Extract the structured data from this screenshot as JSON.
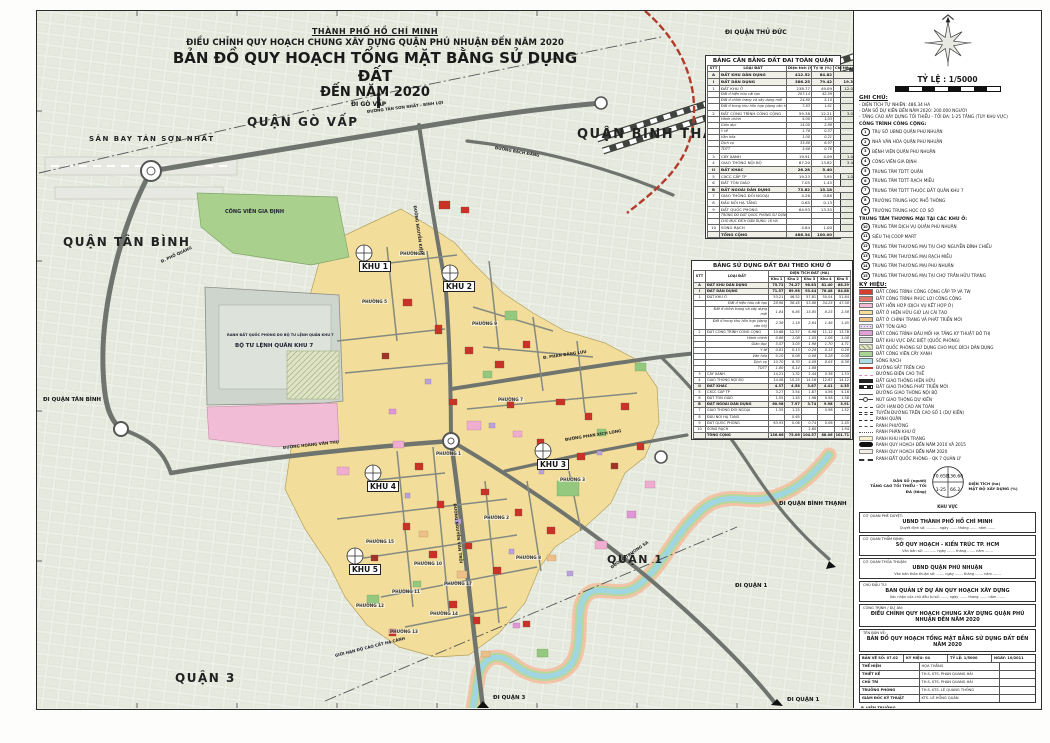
{
  "title": {
    "city": "THÀNH PHỐ HỒ CHÍ MINH",
    "line1": "ĐIỀU CHỈNH QUY HOẠCH CHUNG XÂY DỰNG QUẬN PHÚ NHUẬN ĐẾN NĂM 2020",
    "line2": "BẢN ĐỒ QUY HOẠCH TỔNG MẶT BẰNG SỬ DỤNG ĐẤT",
    "line3": "ĐẾN NĂM 2020"
  },
  "map": {
    "regions": [
      "QUẬN GÒ VẤP",
      "QUẬN BÌNH THẠNH",
      "QUẬN TÂN BÌNH",
      "QUẬN 1",
      "QUẬN 3",
      "SÂN BAY TÂN SƠN NHẤT"
    ],
    "directions": [
      "ĐI QUẬN THỦ ĐỨC",
      "ĐI GÒ VẤP",
      "ĐI QUẬN TÂN BÌNH",
      "ĐI QUẬN BÌNH THẠNH",
      "ĐI QUẬN 1",
      "ĐI QUẬN 1",
      "ĐI QUẬN 3"
    ],
    "khu": [
      "KHU 1",
      "KHU 2",
      "KHU 3",
      "KHU 4",
      "KHU 5"
    ],
    "wards": [
      "PHƯỜNG 4",
      "PHƯỜNG 5",
      "PHƯỜNG 9",
      "PHƯỜNG 7",
      "PHƯỜNG 1",
      "PHƯỜNG 3",
      "PHƯỜNG 2",
      "PHƯỜNG 8",
      "PHƯỜNG 15",
      "PHƯỜNG 10",
      "PHƯỜNG 17",
      "PHƯỜNG 11",
      "PHƯỜNG 12",
      "PHƯỜNG 13",
      "PHƯỜNG 14"
    ],
    "roads": [
      "ĐƯỜNG TÂN SƠN NHẤT - BÌNH LỢI",
      "ĐƯỜNG BẠCH ĐẰNG",
      "ĐƯỜNG NGUYỄN KIỆM",
      "Đ. PHỔ QUANG",
      "ĐƯỜNG HOÀNG VĂN THỤ",
      "Đ. PHAN ĐĂNG LƯU",
      "ĐƯỜNG NGUYỄN VĂN TRỖI",
      "ĐƯỜNG PHAN XÍCH LONG",
      "ĐƯỜNG TRƯỜNG SA"
    ],
    "pois": [
      "CÔNG VIÊN GIA ĐỊNH",
      "RANH ĐẤT QUỐC PHÒNG DO BỘ TƯ LỆNH QUÂN KHU 7",
      "BỘ TƯ LỆNH QUÂN KHU 7",
      "GIỚI HẠN ĐỘ CAO CẤT HẠ CÁNH"
    ]
  },
  "table_quan": {
    "title": "BẢNG CÂN BẰNG ĐẤT ĐAI TOÀN QUẬN",
    "headers": [
      "STT",
      "LOẠI ĐẤT",
      "Diện tích (ha)",
      "Tỷ lệ (%)",
      "Chỉ tiêu (m²/ng)"
    ],
    "rows": [
      {
        "stt": "A",
        "name": "ĐẤT KHU DÂN DỤNG",
        "a": "412.52",
        "b": "84.82",
        "c": "",
        "k": "head"
      },
      {
        "stt": "I",
        "name": "ĐẤT DÂN DỤNG",
        "a": "386.25",
        "b": "79.42",
        "c": "19.3",
        "k": "head"
      },
      {
        "stt": "1",
        "name": "ĐẤT KHU Ở",
        "a": "238.77",
        "b": "49.09",
        "c": "12.0",
        "k": "num"
      },
      {
        "stt": "",
        "name": "Đất ở hiện hữu cải tạo",
        "a": "207.14",
        "b": "42.59",
        "c": "",
        "k": "sub"
      },
      {
        "stt": "",
        "name": "Đất ở chỉnh trang và xây dựng mới",
        "a": "24.80",
        "b": "5.10",
        "c": "",
        "k": "sub"
      },
      {
        "stt": "",
        "name": "Đất ở trong khu hỗn hợp (dạng căn hộ)",
        "a": "7.83",
        "b": "1.61",
        "c": "",
        "k": "sub"
      },
      {
        "stt": "2",
        "name": "ĐẤT CÔNG TRÌNH CÔNG CỘNG",
        "a": "59.38",
        "b": "12.21",
        "c": "3.0",
        "k": "num"
      },
      {
        "stt": "",
        "name": "Hành chính",
        "a": "5.00",
        "b": "1.03",
        "c": "",
        "k": "sub"
      },
      {
        "stt": "",
        "name": "Giáo dục",
        "a": "14.00",
        "b": "2.88",
        "c": "",
        "k": "sub"
      },
      {
        "stt": "",
        "name": "Y tế",
        "a": "1.78",
        "b": "0.37",
        "c": "",
        "k": "sub"
      },
      {
        "stt": "",
        "name": "Văn hóa",
        "a": "1.00",
        "b": "0.21",
        "c": "",
        "k": "sub"
      },
      {
        "stt": "",
        "name": "Dịch vụ",
        "a": "33.88",
        "b": "6.97",
        "c": "",
        "k": "sub"
      },
      {
        "stt": "",
        "name": "TDTT",
        "a": "3.68",
        "b": "0.76",
        "c": "",
        "k": "sub"
      },
      {
        "stt": "3",
        "name": "CÂY XANH",
        "a": "19.91",
        "b": "4.09",
        "c": "1.0",
        "k": "num"
      },
      {
        "stt": "4",
        "name": "GIAO THÔNG NỘI BỘ",
        "a": "67.20",
        "b": "13.82",
        "c": "3.4",
        "k": "num"
      },
      {
        "stt": "II",
        "name": "ĐẤT KHÁC",
        "a": "26.28",
        "b": "5.40",
        "c": "",
        "k": "head"
      },
      {
        "stt": "5",
        "name": "CXCC CẤP TP",
        "a": "19.23",
        "b": "3.95",
        "c": "1.0",
        "k": "num"
      },
      {
        "stt": "6",
        "name": "ĐẤT TÔN GIÁO",
        "a": "7.05",
        "b": "1.45",
        "c": "",
        "k": "num"
      },
      {
        "stt": "B",
        "name": "ĐẤT NGOÀI DÂN DỤNG",
        "a": "73.82",
        "b": "15.18",
        "c": "",
        "k": "head"
      },
      {
        "stt": "7",
        "name": "GIAO THÔNG ĐỐI NGOẠI",
        "a": "4.26",
        "b": "0.88",
        "c": "",
        "k": "num"
      },
      {
        "stt": "8",
        "name": "ĐẤU NỐI HẠ TẦNG",
        "a": "0.65",
        "b": "0.13",
        "c": "",
        "k": "num"
      },
      {
        "stt": "9",
        "name": "ĐẤT QUỐC PHÒNG",
        "a": "64.93",
        "b": "13.35",
        "c": "",
        "k": "num"
      },
      {
        "stt": "",
        "name": "TRONG ĐÓ ĐẤT QUỐC PHÒNG SỬ DỤNG",
        "a": "",
        "b": "",
        "c": "",
        "k": "note"
      },
      {
        "stt": "",
        "name": "CHO MỤC ĐÍCH DÂN DỤNG: 16 HA",
        "a": "",
        "b": "",
        "c": "",
        "k": "note"
      },
      {
        "stt": "10",
        "name": "SÔNG RẠCH",
        "a": "4.84",
        "b": "1.00",
        "c": "",
        "k": "num"
      },
      {
        "stt": "",
        "name": "TỔNG CỘNG",
        "a": "486.34",
        "b": "100.00",
        "c": "",
        "k": "total"
      }
    ]
  },
  "table_khu": {
    "title": "BẢNG SỬ DỤNG ĐẤT ĐAI THEO KHU Ở",
    "group_header": "DIỆN TÍCH ĐẤT (HA)",
    "headers": [
      "STT",
      "LOẠI ĐẤT"
    ],
    "khu_headers": [
      "Khu 1",
      "Khu 2",
      "Khu 3",
      "Khu 4",
      "Khu 5"
    ],
    "rows": [
      {
        "stt": "A",
        "name": "ĐẤT KHU DÂN DỤNG",
        "v": [
          "75.72",
          "74.27",
          "98.83",
          "81.40",
          "88.29"
        ],
        "k": "head"
      },
      {
        "stt": "I",
        "name": "ĐẤT DÂN DỤNG",
        "v": [
          "71.57",
          "69.98",
          "93.44",
          "76.48",
          "84.88"
        ],
        "k": "head"
      },
      {
        "stt": "1",
        "name": "ĐẤT KHU Ở",
        "v": [
          "53.21",
          "46.52",
          "57.81",
          "50.04",
          "51.84"
        ],
        "k": "num"
      },
      {
        "stt": "",
        "name": "Đất ở hiện hữu cải tạo",
        "v": [
          "28.96",
          "36.45",
          "53.88",
          "34.25",
          "47.58"
        ],
        "k": "sub"
      },
      {
        "stt": "",
        "name": "Đất ở chỉnh trang và xây dựng mới",
        "v": [
          "1.84",
          "6.85",
          "15.85",
          "8.25",
          "2.58"
        ],
        "k": "sub"
      },
      {
        "stt": "",
        "name": "Đất ở trong khu hỗn hợp (dạng căn hộ)",
        "v": [
          "2.38",
          "1.18",
          "2.84",
          "1.46",
          "1.45"
        ],
        "k": "sub"
      },
      {
        "stt": "2",
        "name": "ĐẤT CÔNG TRÌNH CÔNG CỘNG",
        "v": [
          "10.68",
          "12.57",
          "8.98",
          "11.12",
          "13.78"
        ],
        "k": "num"
      },
      {
        "stt": "",
        "name": "Hành chính",
        "v": [
          "0.88",
          "1.08",
          "1.05",
          "1.06",
          "1.08"
        ],
        "k": "sub"
      },
      {
        "stt": "",
        "name": "Giáo dục",
        "v": [
          "5.57",
          "3.03",
          "1.98",
          "1.70",
          "4.71"
        ],
        "k": "sub"
      },
      {
        "stt": "",
        "name": "Y tế",
        "v": [
          "0.81",
          "0.13",
          "0.28",
          "0.15",
          "0.28"
        ],
        "k": "sub"
      },
      {
        "stt": "",
        "name": "Văn hóa",
        "v": [
          "0.10",
          "0.08",
          "0.08",
          "0.28",
          "0.08"
        ],
        "k": "sub"
      },
      {
        "stt": "",
        "name": "Dịch vụ",
        "v": [
          "10.70",
          "6.70",
          "4.09",
          "8.05",
          "6.38"
        ],
        "k": "sub"
      },
      {
        "stt": "",
        "name": "TDTT",
        "v": [
          "1.80",
          "0.14",
          "1.88",
          "",
          ""
        ],
        "k": "sub"
      },
      {
        "stt": "3",
        "name": "CÂY XANH",
        "v": [
          "14.21",
          "1.32",
          "2.44",
          "0.36",
          "1.53"
        ],
        "k": "num"
      },
      {
        "stt": "4",
        "name": "GIAO THÔNG NỘI BỘ",
        "v": [
          "14.08",
          "10.25",
          "14.16",
          "12.67",
          "14.12"
        ],
        "k": "num"
      },
      {
        "stt": "II",
        "name": "ĐẤT KHÁC",
        "v": [
          "4.37",
          "4.58",
          "3.87",
          "4.41",
          "4.35"
        ],
        "k": "head"
      },
      {
        "stt": "5",
        "name": "CXCC CẤP TP",
        "v": [
          "3.27",
          "3.54",
          "1.87",
          "4.56",
          "4.16"
        ],
        "k": "num"
      },
      {
        "stt": "6",
        "name": "ĐẤT TÔN GIÁO",
        "v": [
          "1.55",
          "1.45",
          "1.98",
          "0.58",
          "1.58"
        ],
        "k": "num"
      },
      {
        "stt": "B",
        "name": "ĐẤT NGOÀI DÂN DỤNG",
        "v": [
          "60.98",
          "7.97",
          "3.74",
          "9.98",
          "3.91"
        ],
        "k": "head"
      },
      {
        "stt": "7",
        "name": "GIAO THÔNG ĐỐI NGOẠI",
        "v": [
          "1.55",
          "1.25",
          "",
          "0.98",
          "1.52"
        ],
        "k": "num"
      },
      {
        "stt": "8",
        "name": "ĐẤU NỐI HẠ TẦNG",
        "v": [
          "",
          "0.65",
          "",
          "",
          ""
        ],
        "k": "num"
      },
      {
        "stt": "9",
        "name": "ĐẤT QUỐC PHÒNG",
        "v": [
          "63.93",
          "0.06",
          "0.74",
          "0.06",
          "2.45"
        ],
        "k": "num"
      },
      {
        "stt": "10",
        "name": "SÔNG RẠCH",
        "v": [
          "",
          "",
          "2.60",
          "",
          "1.94"
        ],
        "k": "num"
      },
      {
        "stt": "",
        "name": "TỔNG CỘNG",
        "v": [
          "136.66",
          "75.06",
          "104.57",
          "88.06",
          "101.71"
        ],
        "k": "total"
      }
    ]
  },
  "panel": {
    "scale_label": "TỶ LỆ : 1/5000",
    "ghi_chu": {
      "title": "GHI CHÚ:",
      "items": [
        "- DIỆN TÍCH TỰ NHIÊN: 486.34 HA",
        "- DÂN SỐ DỰ KIẾN ĐẾN NĂM 2020: 200.000 NGƯỜI",
        "- TẦNG CAO XÂY DỰNG TỐI THIỂU - TỐI ĐA: 1-25 TẦNG (TÙY KHU VỰC)"
      ]
    },
    "cong_trinh": {
      "title": "CÔNG TRÌNH CÔNG CỘNG:",
      "items": [
        {
          "num": "1",
          "label": "TRỤ SỞ UBND QUẬN PHÚ NHUẬN"
        },
        {
          "num": "2",
          "label": "NHÀ VĂN HÓA QUẬN PHÚ NHUẬN"
        },
        {
          "num": "3",
          "label": "BỆNH VIỆN QUẬN PHÚ NHUẬN"
        },
        {
          "num": "4",
          "label": "CÔNG VIÊN GIA ĐỊNH"
        },
        {
          "num": "5",
          "label": "TRUNG TÂM TDTT QUẬN"
        },
        {
          "num": "6",
          "label": "TRUNG TÂM TDTT RẠCH MIỄU"
        },
        {
          "num": "7",
          "label": "TRUNG TÂM TDTT THUỘC ĐẤT QUÂN KHU 7"
        },
        {
          "num": "8",
          "label": "TRƯỜNG TRUNG HỌC PHỔ THÔNG"
        },
        {
          "num": "9",
          "label": "TRƯỜNG TRUNG HỌC CƠ SỞ"
        }
      ]
    },
    "thuong_mai": {
      "title": "TRUNG TÂM THƯƠNG MẠI TẠI CÁC KHU Ở:",
      "items": [
        {
          "num": "10",
          "label": "TRUNG TÂM DỊCH VỤ QUẬN PHÚ NHUẬN"
        },
        {
          "num": "11",
          "label": "SIÊU THỊ COOP MART"
        },
        {
          "num": "12",
          "label": "TRUNG TÂM THƯƠNG MẠI TẠI CHỢ NGUYỄN ĐÌNH CHIỂU"
        },
        {
          "num": "13",
          "label": "TRUNG TÂM THƯƠNG MẠI RẠCH MIỄU"
        },
        {
          "num": "14",
          "label": "TRUNG TÂM THƯƠNG MẠI PHÚ NHUẬN"
        },
        {
          "num": "15",
          "label": "TRUNG TÂM THƯƠNG MẠI TẠI CHỢ TRẦN HỮU TRANG"
        }
      ]
    },
    "ky_hieu": {
      "title": "KÝ HIỆU:",
      "items": [
        {
          "t": "fill",
          "c": "#d63e2e",
          "label": "ĐẤT CÔNG TRÌNH CÔNG CỘNG CẤP TP VÀ TW"
        },
        {
          "t": "fill",
          "c": "#e2766b",
          "label": "ĐẤT CÔNG TRÌNH PHÚC LỢI CÔNG CỘNG"
        },
        {
          "t": "fill",
          "c": "#f2b9d5",
          "label": "ĐẤT HỖN HỢP (DỊCH VỤ KẾT HỢP Ở)"
        },
        {
          "t": "fill",
          "c": "#f4dd96",
          "label": "ĐẤT Ở HIỆN HỮU GIỮ LẠI CẢI TẠO"
        },
        {
          "t": "fill",
          "c": "#f0c083",
          "label": "ĐẤT Ở CHỈNH TRANG VÀ PHÁT TRIỂN MỚI"
        },
        {
          "t": "dots",
          "c": "#9b7cc0",
          "c2": "#e7dcf2",
          "label": "ĐẤT TÔN GIÁO"
        },
        {
          "t": "fill",
          "c": "#e39fd9",
          "label": "ĐẤT CÔNG TRÌNH ĐẦU MỐI HẠ TẦNG KỸ THUẬT ĐÔ THỊ"
        },
        {
          "t": "fill",
          "c": "#ced3cb",
          "label": "ĐẤT KHU VỰC ĐẶC BIỆT (QUỐC PHÒNG)"
        },
        {
          "t": "hatch",
          "c": "#9aa86e",
          "c2": "#dfe3c8",
          "label": "ĐẤT QUỐC PHÒNG SỬ DỤNG CHO MỤC ĐÍCH DÂN DỤNG"
        },
        {
          "t": "fill",
          "c": "#a8d494",
          "label": "ĐẤT CÔNG VIÊN CÂY XANH"
        },
        {
          "t": "fill",
          "c": "#aadce6",
          "label": "SÔNG RẠCH"
        },
        {
          "t": "line",
          "c": "#c2392b",
          "label": "ĐƯỜNG SẮT TRÊN CAO"
        },
        {
          "t": "dashline",
          "c": "#e08ab8",
          "label": "ĐƯỜNG ĐIỆN CAO THẾ"
        },
        {
          "t": "bar",
          "c": "#222222",
          "label": "ĐẤT GIAO THÔNG HIỆN HỮU"
        },
        {
          "t": "bardash",
          "c": "#222222",
          "label": "ĐẤT GIAO THÔNG PHÁT TRIỂN MỚI"
        },
        {
          "t": "thin",
          "c": "#555555",
          "label": "ĐƯỜNG GIAO THÔNG NỘI BỘ"
        },
        {
          "t": "node",
          "c": "#444444",
          "label": "NÚT GIAO THÔNG DỰ KIẾN"
        },
        {
          "t": "dashdot",
          "c": "#444444",
          "label": "GIỚI HẠN ĐỘ CAO AN TOÀN"
        },
        {
          "t": "ddash",
          "c": "#333333",
          "label": "TUYẾN ĐƯỜNG TRÊN CAO SỐ 1 (DỰ KIẾN)"
        },
        {
          "t": "dashdot",
          "c": "#222222",
          "label": "RANH QUẬN"
        },
        {
          "t": "dashline",
          "c": "#555555",
          "label": "RANH PHƯỜNG"
        },
        {
          "t": "dotline",
          "c": "#555555",
          "label": "RANH PHÂN KHU Ở"
        },
        {
          "t": "khubox",
          "c": "#f8f2cf",
          "label": "RANH KHU HIỆN TRẠNG"
        },
        {
          "t": "bar2010",
          "c": "#111111",
          "label": "RANH QUY HOẠCH ĐẾN NĂM 2010 VÀ 2015"
        },
        {
          "t": "box2020",
          "c": "#f2efe2",
          "label": "RANH QUY HOẠCH ĐẾN NĂM 2020"
        },
        {
          "t": "qpdash",
          "c": "#333333",
          "label": "RANH ĐẤT QUỐC PHÒNG - QK 7 QUẢN LÝ"
        }
      ]
    },
    "diagram": {
      "dan_so": "DÂN SỐ (người)",
      "dien_tich": "DIỆN TÍCH (ha)",
      "tang_cao": "TẦNG CAO TỐI THIỂU - TỐI ĐA (tầng)",
      "mat_do": "MẬT ĐỘ XÂY DỰNG (%)",
      "khu_vuc": "KHU VỰC",
      "values": {
        "v1": "70.658",
        "v2": "136.66",
        "v3": "1-25",
        "v4": "66.2"
      }
    },
    "blocks": [
      {
        "label": "CƠ QUAN PHÊ DUYỆT:",
        "name": "UBND THÀNH PHỐ HỒ CHÍ MINH",
        "line": "Quyết định số: ........... ngày ....... tháng ....... năm ......."
      },
      {
        "label": "CƠ QUAN THẨM ĐỊNH:",
        "name": "SỞ QUY HOẠCH - KIẾN TRÚC TP. HCM",
        "line": "Văn bản số: ........... ngày ....... tháng ....... năm ......."
      },
      {
        "label": "CƠ QUAN THỎA THUẬN:",
        "name": "UBND QUẬN PHÚ NHUẬN",
        "line": "Văn bản thỏa thuận số: ....... ngày ....... tháng ....... năm ......."
      },
      {
        "label": "CHỦ ĐẦU TƯ:",
        "name": "BAN QUẢN LÝ DỰ ÁN QUY HOẠCH XÂY DỰNG",
        "line": "Xác nhận của chủ đầu tư số: ....... ngày ....... tháng ....... năm ......."
      },
      {
        "label": "CÔNG TRÌNH / DỰ ÁN:",
        "name": "ĐIỀU CHỈNH QUY HOẠCH CHUNG XÂY DỰNG QUẬN PHÚ NHUẬN ĐẾN NĂM 2020",
        "line": ""
      },
      {
        "label": "TÊN BẢN VẼ:",
        "name": "BẢN ĐỒ QUY HOẠCH TỔNG MẶT BẰNG SỬ DỤNG ĐẤT ĐẾN NĂM 2020",
        "line": ""
      }
    ],
    "drawing_info": {
      "row0": [
        "BẢN VẼ SỐ: 07.02",
        "KÝ HIỆU: 04",
        "TỶ LỆ: 1/5000",
        "NGÀY: 10/2011"
      ],
      "rows": [
        {
          "label": "THỂ HIỆN",
          "value": "HỌA THẮNG"
        },
        {
          "label": "THIẾT KẾ",
          "value": "TH.S. KTS. PHAN QUANG HẢI"
        },
        {
          "label": "CHỦ TRÌ",
          "value": "TH.S. KTS. PHAN QUANG HẢI"
        },
        {
          "label": "TRƯỞNG PHÒNG",
          "value": "TH.S. KTS. LÊ QUANG THỐNG"
        },
        {
          "label": "GIÁM ĐỐC KỸ THUẬT",
          "value": "KTS. LÊ HỒNG QUÂN"
        }
      ]
    },
    "signature": {
      "title": "P. VIỆN TRƯỞNG",
      "name": "TS. KTS. PHAN SỸ CHÂU"
    },
    "institute": {
      "line1": "VIỆN NGHIÊN CỨU PHÁT TRIỂN THÀNH PHỐ HCM",
      "line2": "VIỆN QUY HOẠCH XÂY DỰNG",
      "line3": "TRỤ SỞ: 216 NGUYỄN ĐÌNH CHIỂU - Q.3 - ĐT: 3930724 - FAX: 3930725"
    },
    "footer": [
      "ĐIỀU CHỈNH QUY HOẠCH CHUNG XÂY DỰNG QUẬN PHÚ NHUẬN ĐẾN NĂM 2020",
      "TÊN BẢN VẼ: BẢN ĐỒ QUY HOẠCH TỔNG MẶT BẰNG SỬ DỤNG ĐẤT ĐẾN NĂM 2020"
    ]
  }
}
